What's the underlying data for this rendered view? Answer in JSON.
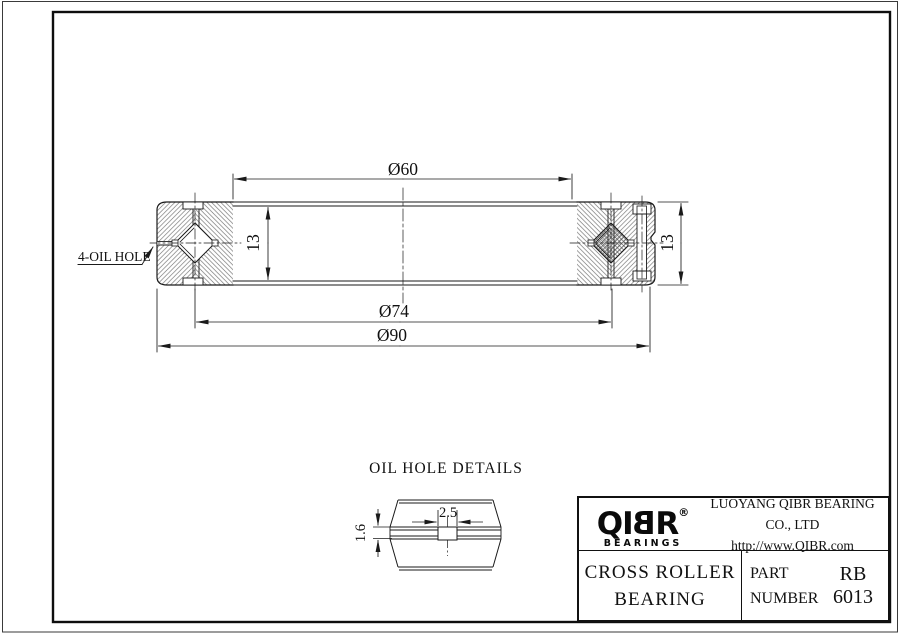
{
  "colors": {
    "line": "#1a1a1a",
    "hatch": "#707070",
    "background": "#ffffff"
  },
  "drawing": {
    "dims": {
      "bore": "Ø60",
      "pitch": "Ø74",
      "od": "Ø90",
      "width_left": "13",
      "width_right": "13"
    },
    "oil_hole_label": "4-OIL HOLE",
    "detail": {
      "title": "OIL HOLE DETAILS",
      "hole_width": "2.5",
      "hole_depth": "1.6"
    }
  },
  "title_block": {
    "logo_qi": "QI",
    "logo_b": "B",
    "logo_r": "R",
    "logo_reg": "®",
    "logo_sub": "BEARINGS",
    "company": "LUOYANG QIBR BEARING CO., LTD",
    "website": "http://www.QIBR.com",
    "product_line1": "CROSS ROLLER",
    "product_line2": "BEARING",
    "part_label_line1": "PART",
    "part_label_line2": "NUMBER",
    "part_number": "RB 6013"
  }
}
